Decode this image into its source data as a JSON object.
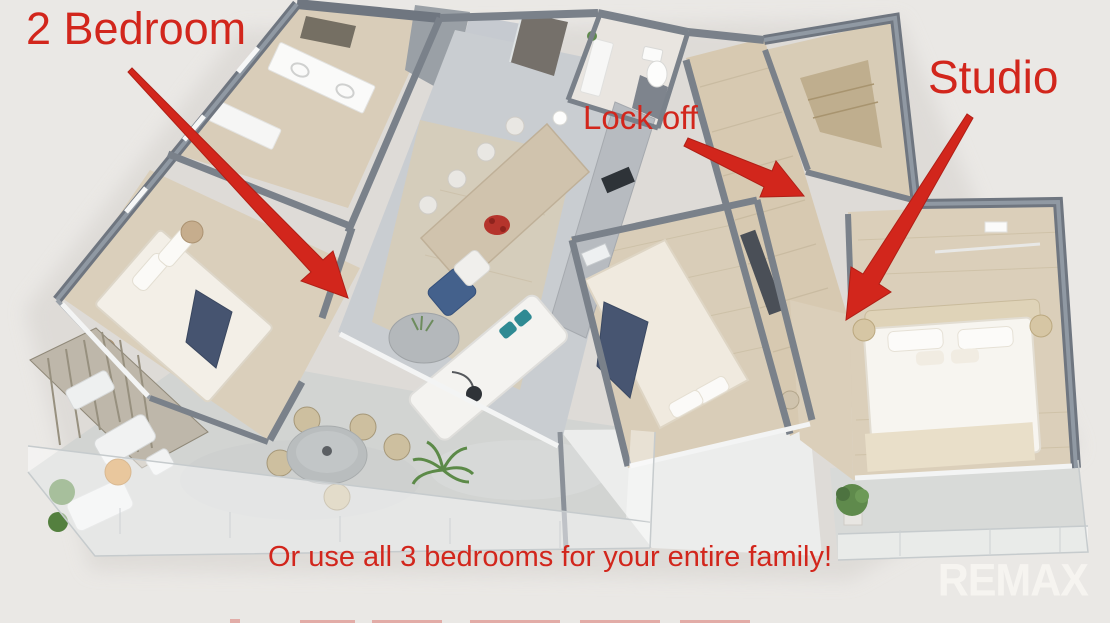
{
  "annotations": {
    "two_bedroom_label": "2 Bedroom",
    "lock_off_label": "Lock off",
    "studio_label": "Studio",
    "caption": "Or use all 3 bedrooms for your entire family!"
  },
  "branding": {
    "logo_text": "REMAX"
  },
  "colors": {
    "annotation_red": "#d2261c",
    "background": "#eae8e5",
    "wall_gray": "#7a818a",
    "wood_floor": "#d9cdb8",
    "tile_floor": "#c9cdd1",
    "terrace_floor": "#d2d4d2",
    "navy_accent": "#475571",
    "logo_white": "#f6f4f0"
  }
}
